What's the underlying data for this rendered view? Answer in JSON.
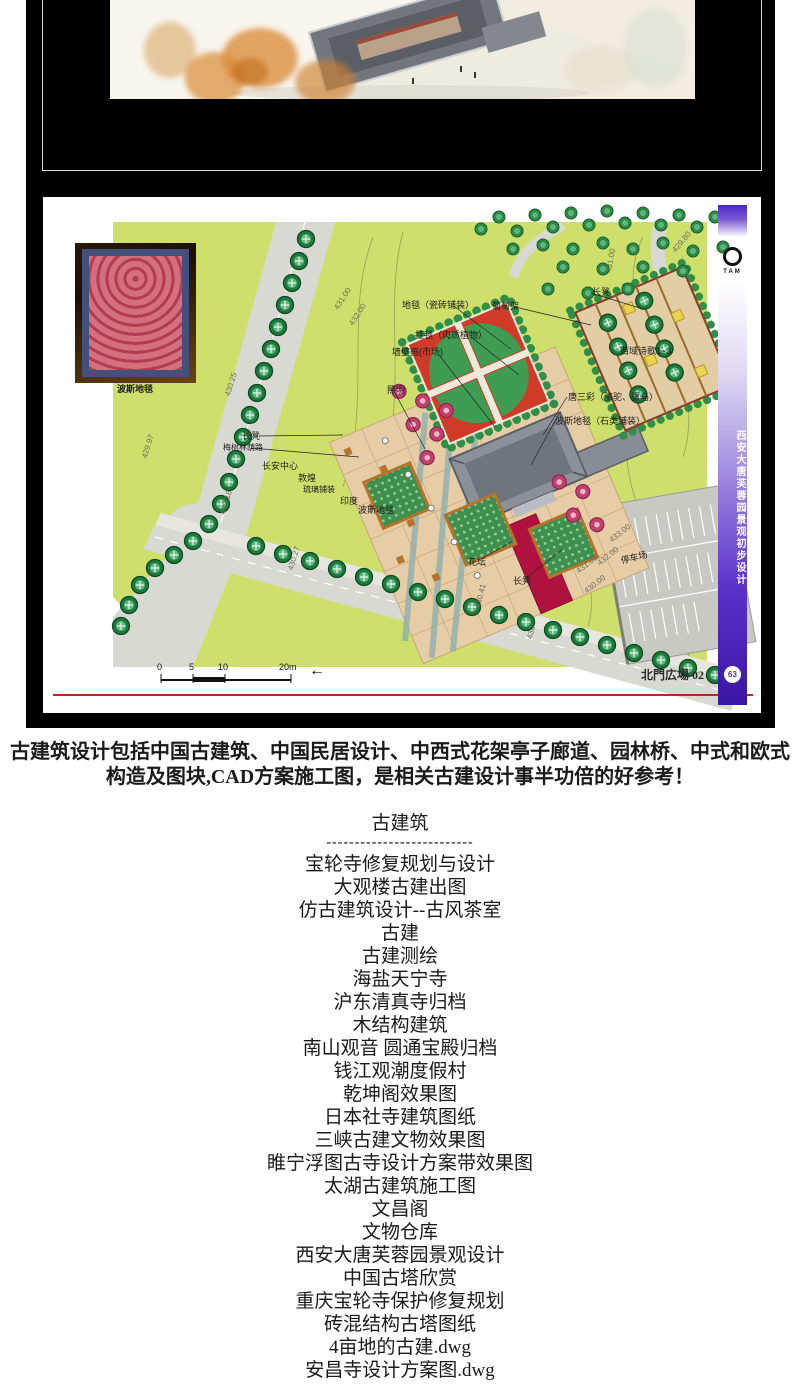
{
  "plan": {
    "carpet_caption": "波斯地毯",
    "labels": [
      "地毯（瓷砖铺装）",
      "挂毯（肉质植物）",
      "墙壁画(市场)",
      "照明",
      "葡萄架",
      "长凳",
      "西域诗歌1~3",
      "唐三彩（骆驼、骡马）",
      "波斯地毯（石类铺装）",
      "长凳",
      "梅树林荫路",
      "长安中心",
      "敦煌",
      "琉璃铺装",
      "印度",
      "波斯地毯",
      "花坛",
      "长凳",
      "停车场"
    ],
    "contours": [
      "431.00",
      "431.00",
      "432.00",
      "429.80",
      "430.25",
      "429.97",
      "430.18",
      "430.27",
      "430.41",
      "430",
      "433.00",
      "432.00",
      "431.00",
      "430.00"
    ],
    "scalebar": [
      "0",
      "5",
      "10",
      "20m"
    ],
    "scale_arrow": "←",
    "sheet_title": "北門広場 02",
    "sidebar": {
      "logo_text": "TAM",
      "vertical_title": "西安大唐芙蓉园景观初步设计",
      "page_badge": "63"
    },
    "colors": {
      "green": "#cedf6b",
      "road": "#d9d9d3",
      "plaza_tan": "#e6cda6",
      "plaza_red": "#d03a28",
      "carpet_red": "#b01240",
      "sidebar_purple": "#4a28c8",
      "red_rule": "#c32222"
    }
  },
  "description": {
    "line1": "古建筑设计包括中国古建筑、中国民居设计、中西式花架亭子廊道、园林桥、中式和欧式",
    "line2": "构造及图块,CAD方案施工图，是相关古建设计事半功倍的好参考！"
  },
  "catalog": {
    "heading": "古建筑",
    "divider": "--------------------------",
    "items": [
      "宝轮寺修复规划与设计",
      "大观楼古建出图",
      "仿古建筑设计--古风茶室",
      "古建",
      "古建测绘",
      "海盐天宁寺",
      "沪东清真寺归档",
      "木结构建筑",
      "南山观音 圆通宝殿归档",
      "钱江观潮度假村",
      "乾坤阁效果图",
      "日本社寺建筑图纸",
      "三峡古建文物效果图",
      "睢宁浮图古寺设计方案带效果图",
      "太湖古建筑施工图",
      "文昌阁",
      "文物仓库",
      "西安大唐芙蓉园景观设计",
      "中国古塔欣赏",
      "重庆宝轮寺保护修复规划",
      "砖混结构古塔图纸",
      "4亩地的古建.dwg",
      "安昌寺设计方案图.dwg"
    ]
  }
}
